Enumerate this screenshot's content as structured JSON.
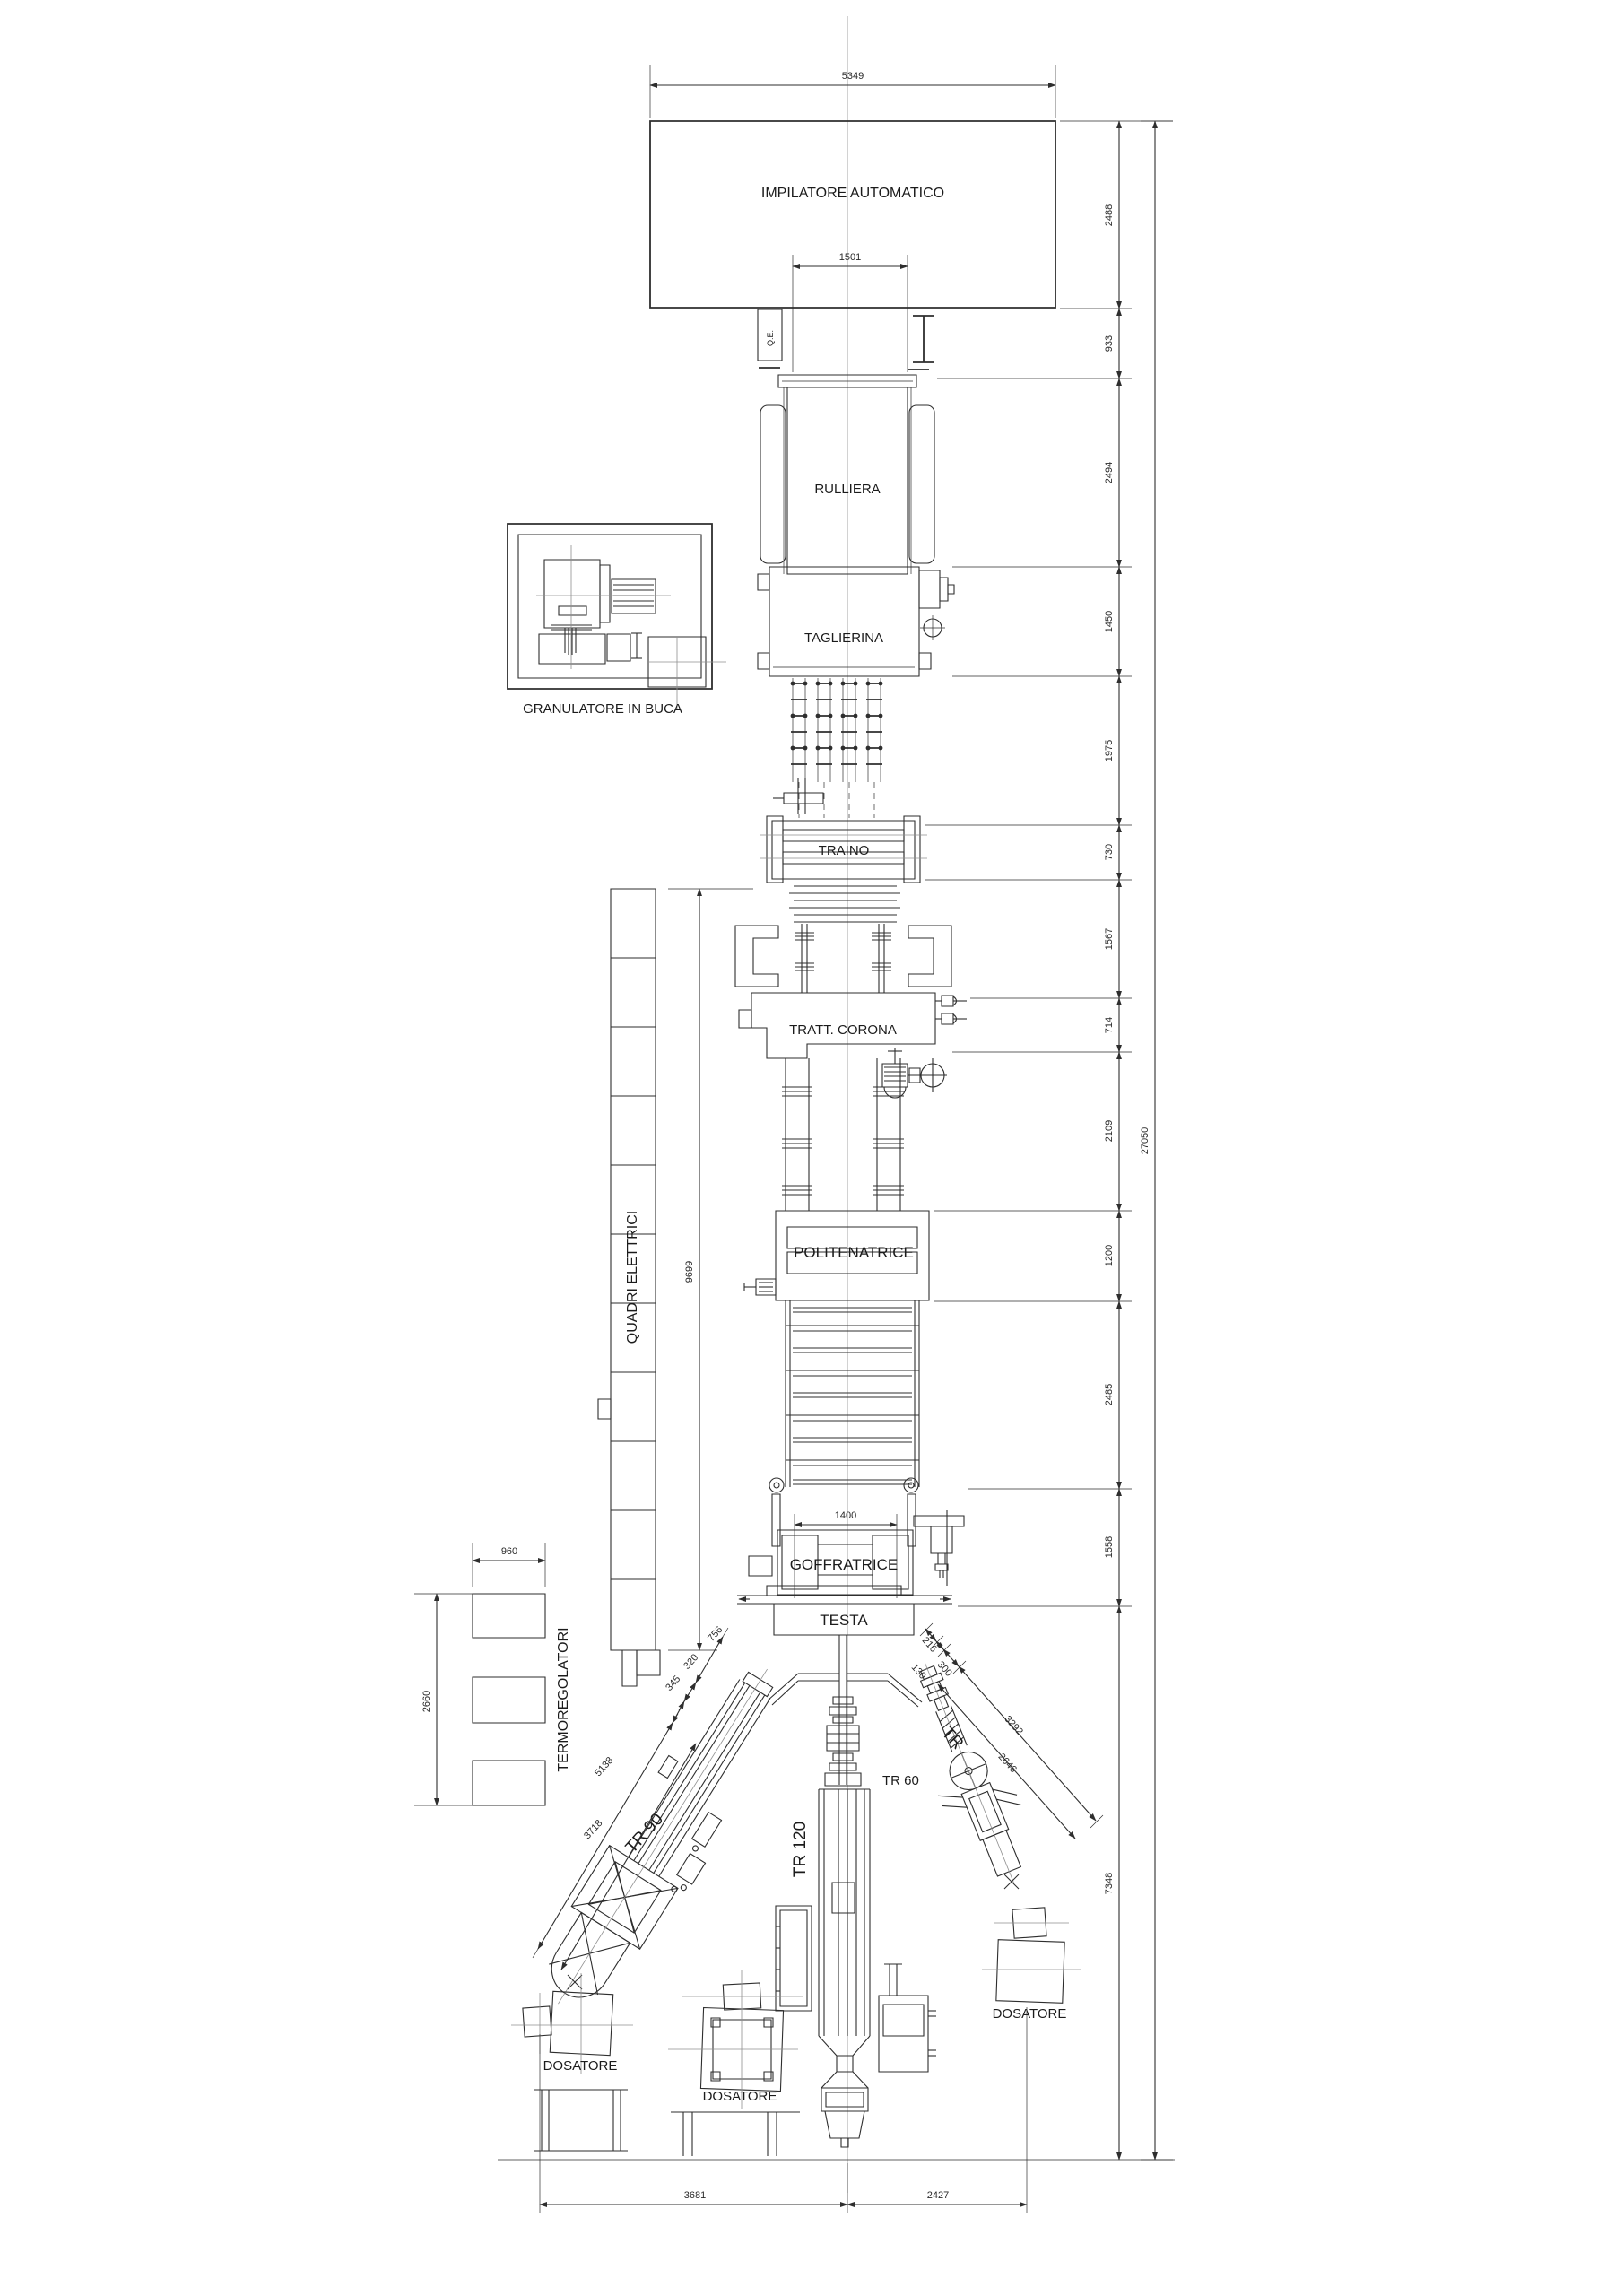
{
  "machine_labels": {
    "impilatore": "IMPILATORE AUTOMATICO",
    "rulliera": "RULLIERA",
    "taglierina": "TAGLIERINA",
    "granulatore": "GRANULATORE IN BUCA",
    "traino": "TRAINO",
    "tratt_corona": "TRATT. CORONA",
    "politenatrice": "POLITENATRICE",
    "quadri_elettrici": "QUADRI ELETTRICI",
    "goffratrice": "GOFFRATRICE",
    "testa": "TESTA",
    "termoregolatori": "TERMOREGOLATORI",
    "tr90": "TR 90",
    "tr120": "TR 120",
    "tr60": "TR 60",
    "tr_small": "TR",
    "dosatore_left": "DOSATORE",
    "dosatore_center": "DOSATORE",
    "dosatore_right": "DOSATORE",
    "qe": "Q.E."
  },
  "dimensions": {
    "top_width": "5349",
    "impilatore_offset": "1501",
    "right_chain": [
      "2488",
      "933",
      "2494",
      "1450",
      "1975",
      "730",
      "1567",
      "714",
      "2109",
      "1200",
      "2485",
      "1558",
      "7348"
    ],
    "overall_length": "27050",
    "goffratrice_width": "1400",
    "quadri_height": "9699",
    "termo_width": "960",
    "termo_height": "2660",
    "tr90_chain": [
      "756",
      "320",
      "345",
      "3718"
    ],
    "tr90_total": "5138",
    "tr60_chain": [
      "216",
      "130",
      "300",
      "2646"
    ],
    "tr60_total": "3292",
    "bottom_left": "3681",
    "bottom_right": "2427"
  }
}
